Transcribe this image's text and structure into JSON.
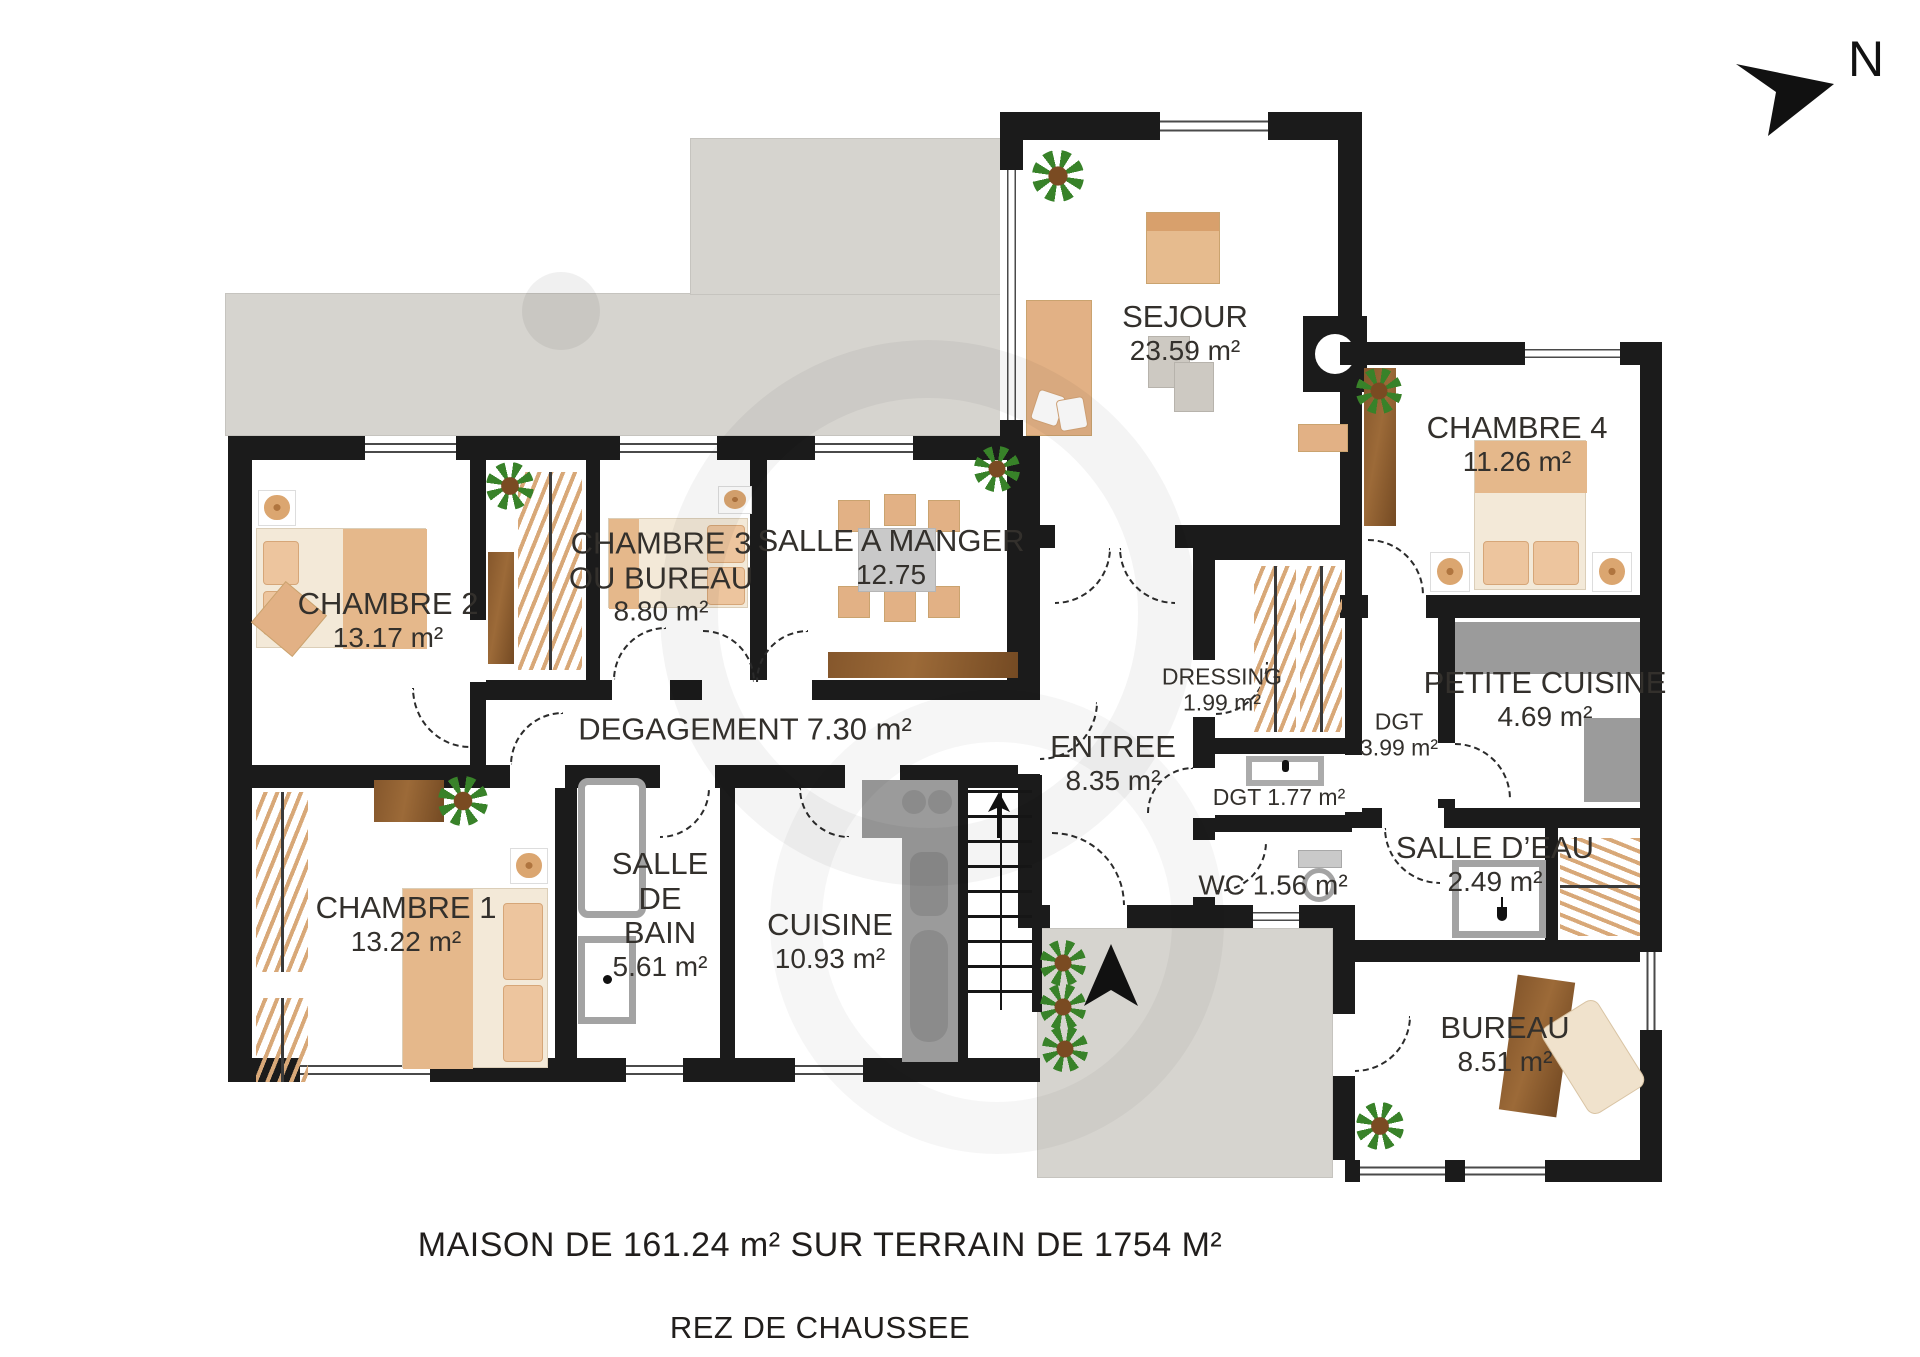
{
  "title": "MAISON DE 161.24 m² SUR TERRAIN DE 1754 M²",
  "subtitle": "REZ DE CHAUSSEE",
  "compass": {
    "north_label": "N"
  },
  "colors": {
    "wall": "#1b1b1b",
    "terrace": "#d6d4cf",
    "wood": "#85572c",
    "counter": "#9b9b9b",
    "plant_green": "#388229",
    "furniture_tan": "#e2b185"
  },
  "icons": {
    "north_arrow": "north-arrow-icon",
    "entrance_arrow": "entrance-arrow-icon",
    "stairs_up_arrow": "stairs-up-arrow-icon"
  },
  "rooms": {
    "sejour": {
      "name": "SEJOUR",
      "area": "23.59 m²"
    },
    "chambre4": {
      "name": "CHAMBRE 4",
      "area": "11.26 m²"
    },
    "chambre2": {
      "name": "CHAMBRE 2",
      "area": "13.17 m²"
    },
    "chambre3": {
      "name": "CHAMBRE 3",
      "name2": "OU BUREAU",
      "area": "8.80 m²"
    },
    "salle_a_manger": {
      "name": "SALLE A MANGER",
      "area": "12.75"
    },
    "degagement": {
      "name": "DEGAGEMENT 7.30 m²"
    },
    "entree": {
      "name": "ENTREE",
      "area": "8.35 m²"
    },
    "dressing": {
      "name": "DRESSING",
      "area": "1.99 m²"
    },
    "dgt399": {
      "name": "DGT",
      "area": "3.99 m²"
    },
    "dgt177": {
      "name": "DGT 1.77 m²"
    },
    "petite_cuisine": {
      "name": "PETITE CUISINE",
      "area": "4.69 m²"
    },
    "salle_deau": {
      "name": "SALLE D’EAU",
      "area": "2.49 m²"
    },
    "wc": {
      "name": "WC 1.56 m²"
    },
    "bureau": {
      "name": "BUREAU",
      "area": "8.51 m²"
    },
    "chambre1": {
      "name": "CHAMBRE 1",
      "area": "13.22 m²"
    },
    "salle_de_bain": {
      "name": "SALLE",
      "name2": "DE",
      "name3": "BAIN",
      "area": "5.61 m²"
    },
    "cuisine": {
      "name": "CUISINE",
      "area": "10.93 m²"
    }
  }
}
